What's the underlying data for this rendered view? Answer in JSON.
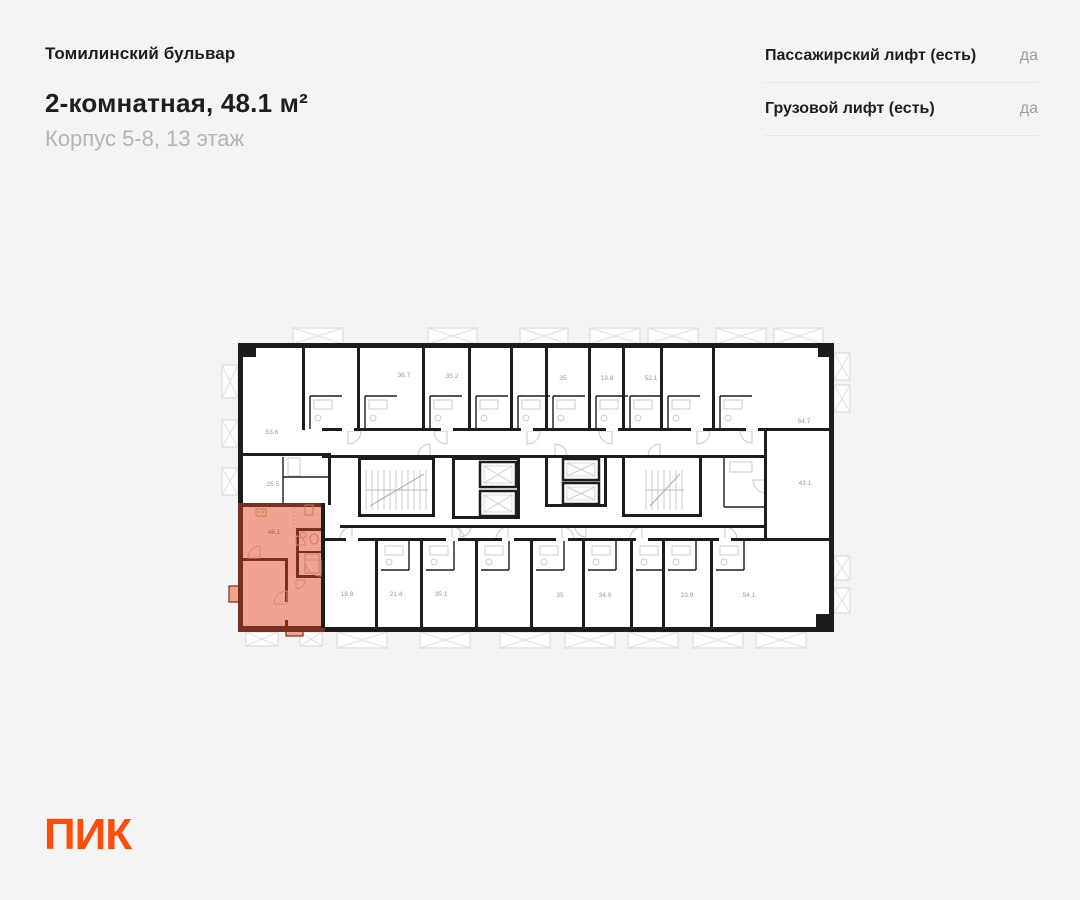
{
  "header": {
    "project": "Томилинский бульвар",
    "title": "2-комнатная, 48.1 м²",
    "subtitle": "Корпус 5-8, 13 этаж"
  },
  "info_panel": {
    "rows": [
      {
        "label": "Пассажирский лифт (есть)",
        "value": "да"
      },
      {
        "label": "Грузовой лифт (есть)",
        "value": "да"
      }
    ]
  },
  "floorplan": {
    "selected_apartment": {
      "area_label": "48.1",
      "label_x": 274,
      "label_y": 534
    },
    "area_labels": [
      {
        "t": "53.6",
        "x": 272,
        "y": 434
      },
      {
        "t": "36.7",
        "x": 404,
        "y": 377
      },
      {
        "t": "35.2",
        "x": 452,
        "y": 378
      },
      {
        "t": "35",
        "x": 563,
        "y": 380
      },
      {
        "t": "19.8",
        "x": 607,
        "y": 380
      },
      {
        "t": "52.1",
        "x": 651,
        "y": 380
      },
      {
        "t": "54.7",
        "x": 804,
        "y": 423
      },
      {
        "t": "25.5",
        "x": 273,
        "y": 486
      },
      {
        "t": "43.1",
        "x": 805,
        "y": 485
      },
      {
        "t": "18.9",
        "x": 347,
        "y": 596
      },
      {
        "t": "21.4",
        "x": 396,
        "y": 596
      },
      {
        "t": "35.1",
        "x": 441,
        "y": 596
      },
      {
        "t": "35",
        "x": 560,
        "y": 597
      },
      {
        "t": "34.9",
        "x": 605,
        "y": 597
      },
      {
        "t": "23.9",
        "x": 687,
        "y": 597
      },
      {
        "t": "54.1",
        "x": 749,
        "y": 597
      }
    ],
    "colors": {
      "wall": "#1d1d1d",
      "highlight_fill": "#f2a38f",
      "highlight_wall": "#76301d",
      "label": "#9a9a9a",
      "selected_label": "#a75d49"
    }
  },
  "logo": {
    "text": "ПИК"
  }
}
